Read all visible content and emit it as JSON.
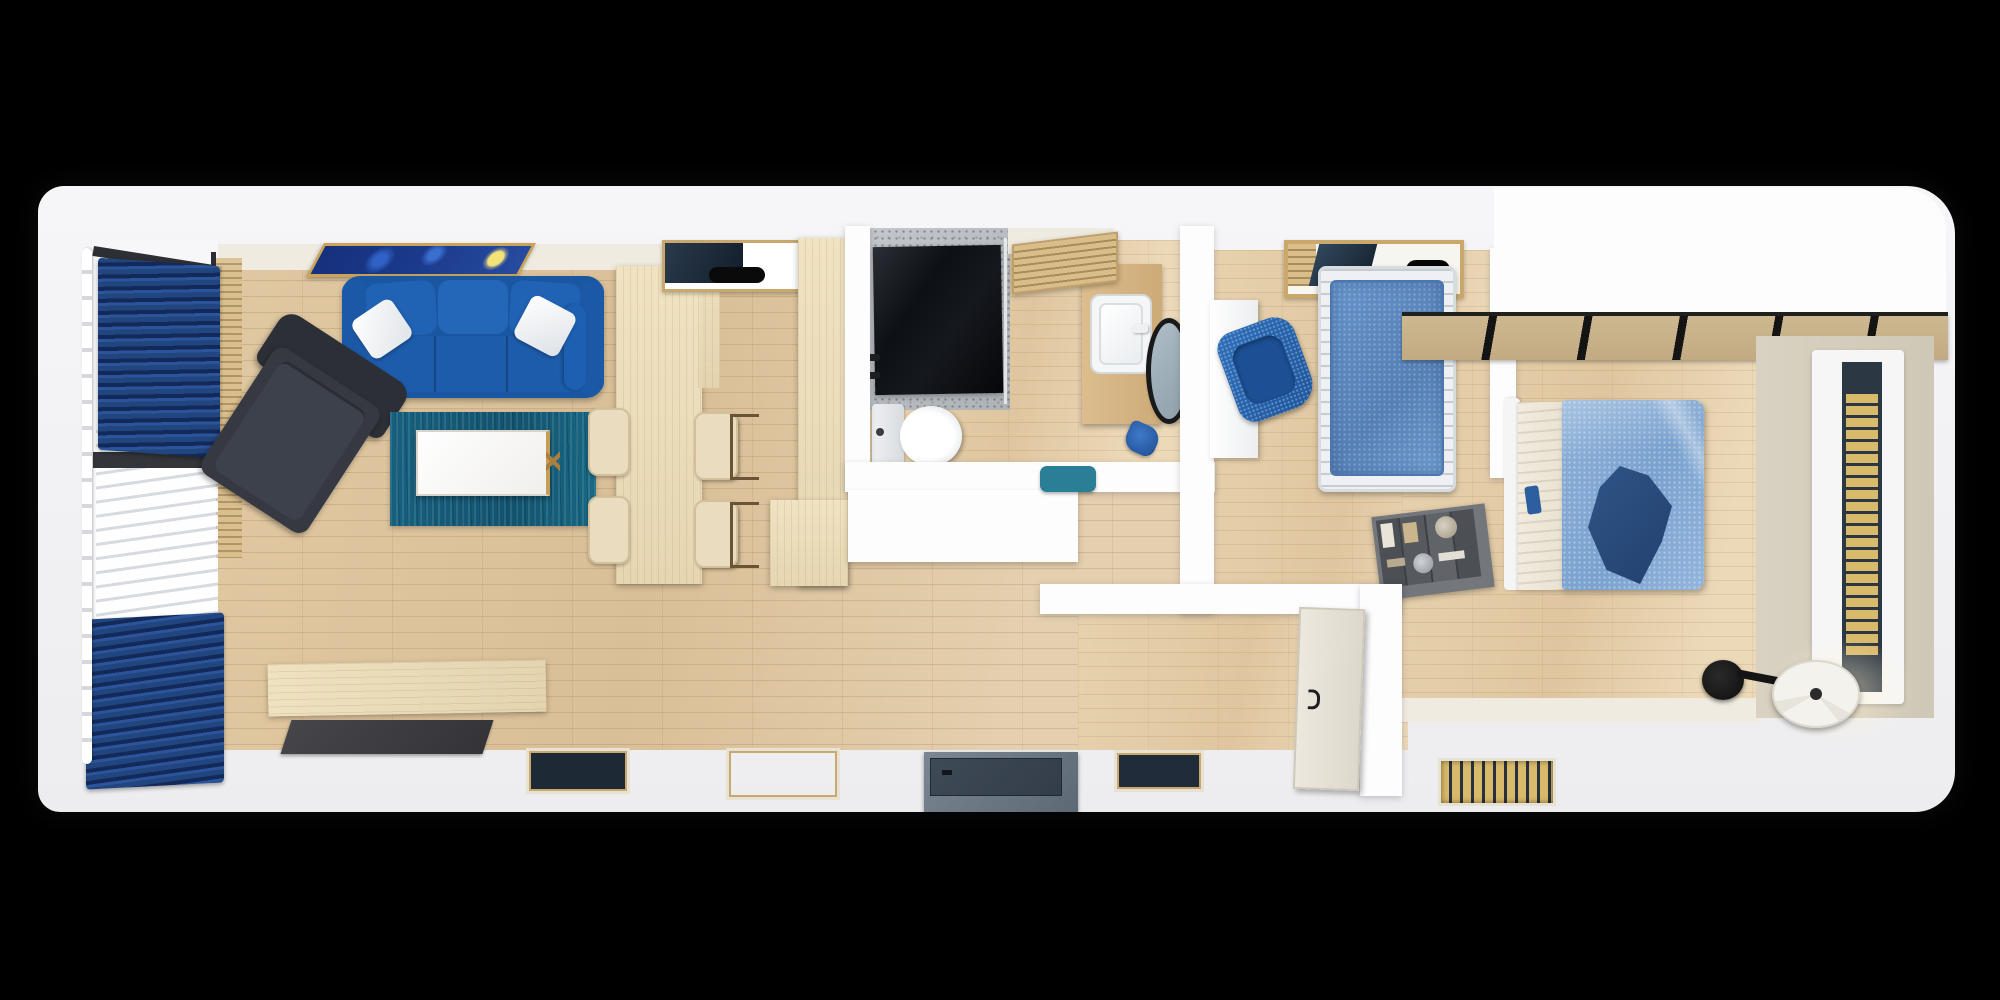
{
  "scene": {
    "title": "Top-down 3D rendered floor plan of a narrow one-bedroom tiny home",
    "view": "orthographic top-down dollhouse render",
    "background": "black letterbox"
  },
  "palette": {
    "background": "#000000",
    "wall_white": "#fdfdfe",
    "floor_wood": "#ddc5a0",
    "pale_wood": "#ecdcba",
    "sofa_blue": "#2063b4",
    "curtain_navy": "#1b3a75",
    "rug_teal": "#15607f",
    "armchair_gray": "#34373e",
    "daybed_blue": "#5e8fc7",
    "duvet_blue": "#83a9d2",
    "throw_navy": "#2a4c7d",
    "shower_black": "#15181d",
    "vanity_wood": "#d8b788",
    "beige_wall": "#d7d0c0",
    "slat_wood": "#d9b96a",
    "accent_teal": "#2a7f96",
    "lamp_shade": "#f4f2ec",
    "painting_gold": "#c9a45a"
  },
  "labels": {
    "plan": "Floor plan render",
    "living_room": "Living room",
    "kitchen_dining": "Kitchen and dining area",
    "bathroom": "Bathroom",
    "office_room": "Study / kids room with daybed",
    "bedroom": "Bedroom",
    "hallway": "Entry hallway",
    "window_wall": "Left glazed wall with curtains",
    "curtain_top": "Navy curtain (upper)",
    "curtain_bottom": "Navy curtain (lower)",
    "sheer_curtain": "White sheer curtain",
    "curtain_rail": "Curtain rail",
    "window_sill": "Wood window sill slats",
    "wall_art": "Starry-night style framed painting",
    "sofa": "Blue three-seat sofa with white pillows",
    "pillow": "White throw pillow",
    "armchair": "Dark gray lounge armchair",
    "rug": "Teal area rug",
    "coffee_table": "White coffee table with wood legs",
    "bench": "Low wooden bench",
    "doormat": "Dark doormat",
    "island": "Wooden dining island counter",
    "dining_chair": "Cream dining chair",
    "top_window": "Clerestory window",
    "tall_cabinet": "Tall wooden cabinet",
    "shower": "Walk-in shower with black glass panel",
    "shower_fixture": "Shower mixer fixtures",
    "toilet": "Toilet",
    "vanity": "Wood vanity counter",
    "sink": "White wash basin",
    "mirror": "Round black-framed mirror",
    "towel": "Blue hand towel",
    "bathroom_door": "Louvered bathroom door (open)",
    "console": "White console cabinet",
    "tray": "Teal decorative tray",
    "desk": "White desk",
    "desk_chair": "Blue desk chair",
    "daybed": "Single daybed with blue mattress",
    "roof_window": "Roof window with wood frame",
    "bookshelf": "Gray cube bookshelf with books and jars",
    "interior_door": "Bedroom door (open leaf)",
    "bed": "Double bed",
    "mattress": "White mattress and sheet",
    "duvet": "Light blue duvet",
    "throw_blanket": "Navy throw blanket",
    "floor_lamp": "Black floor lamp with white shade",
    "slat_window": "Tall window with wood-slat blind",
    "floor_window_1": "Low window slit (living, left)",
    "floor_window_2": "Low window slit (living, right)",
    "floor_window_3": "Low window slit (hall)",
    "floor_window_4": "Low window slit (bedroom)",
    "entry_hatch": "Entry step / floor hatch",
    "glazed_band": "Glazed roof band with black mullions",
    "beige_wall": "Bedroom side wall (beige)"
  }
}
